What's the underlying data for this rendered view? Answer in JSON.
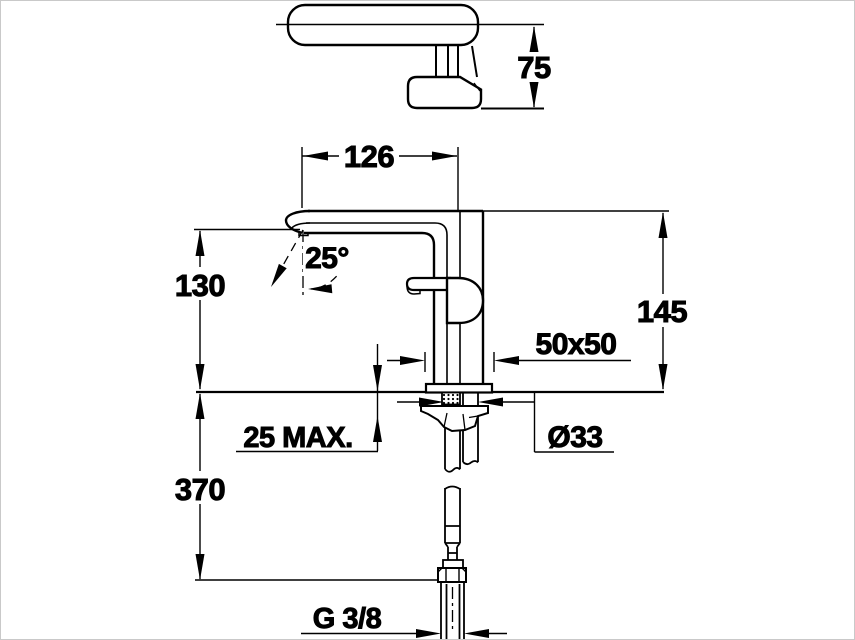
{
  "drawing": {
    "type": "technical-dimension-drawing",
    "subject": "single-lever basin mixer faucet, front and top views",
    "colors": {
      "line": "#000000",
      "background": "#ffffff",
      "frame": "#c9c9c9"
    },
    "labels": {
      "handle_height": "75",
      "spout_reach": "126",
      "stream_angle": "25°",
      "spout_height": "130",
      "total_height": "145",
      "base_footprint": "50x50",
      "max_deck_thickness": "25 MAX.",
      "mounting_hole_diameter": "Ø33",
      "supply_hose_length": "370",
      "connection_thread": "G 3/8"
    }
  }
}
